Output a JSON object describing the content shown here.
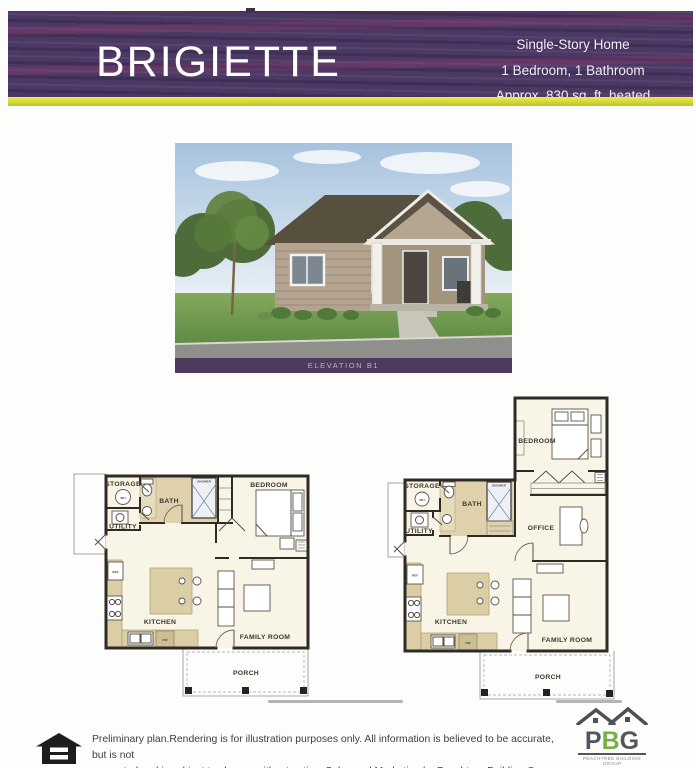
{
  "header": {
    "title": "BRIGIETTE",
    "line1": "Single-Story Home",
    "line2": "1 Bedroom, 1 Bathroom",
    "line3": "Approx. 830 sq. ft. heated"
  },
  "elevation": {
    "caption": "ELEVATION B1"
  },
  "plan_a": {
    "storage": "STORAGE",
    "bath": "BATH",
    "bedroom": "BEDROOM",
    "utility": "UTILITY",
    "kitchen": "KITCHEN",
    "family_room": "FAMILY ROOM",
    "porch": "PORCH",
    "shower": "SHOWER",
    "wh": "WH",
    "dw": "DW",
    "ref": "REF"
  },
  "plan_b": {
    "storage": "STORAGE",
    "bath": "BATH",
    "bedroom": "BEDROOM",
    "utility": "UTILITY",
    "office": "OFFICE",
    "kitchen": "KITCHEN",
    "family_room": "FAMILY ROOM",
    "porch": "PORCH",
    "shower": "SHOWER",
    "wh": "WH",
    "dw": "DW",
    "ref": "REF"
  },
  "footer": {
    "disclaimer_line1": "Preliminary plan.Rendering is for illustration purposes only. All information is believed to be accurate, but is not",
    "disclaimer_line2": "warranted and is subject to change without notice. Sales and Marketing by Peachtree Building Group. Effective 2024-11-12",
    "logo": {
      "p": "P",
      "b": "B",
      "g": "G",
      "tagline": "PEACHTREE BUILDING GROUP",
      "website": "pbgbuilt.com"
    }
  },
  "colors": {
    "banner_purple": "#4c3864",
    "stripe_yellow": "#d3d72f",
    "logo_green": "#6fae3e",
    "logo_gray": "#53575c"
  }
}
